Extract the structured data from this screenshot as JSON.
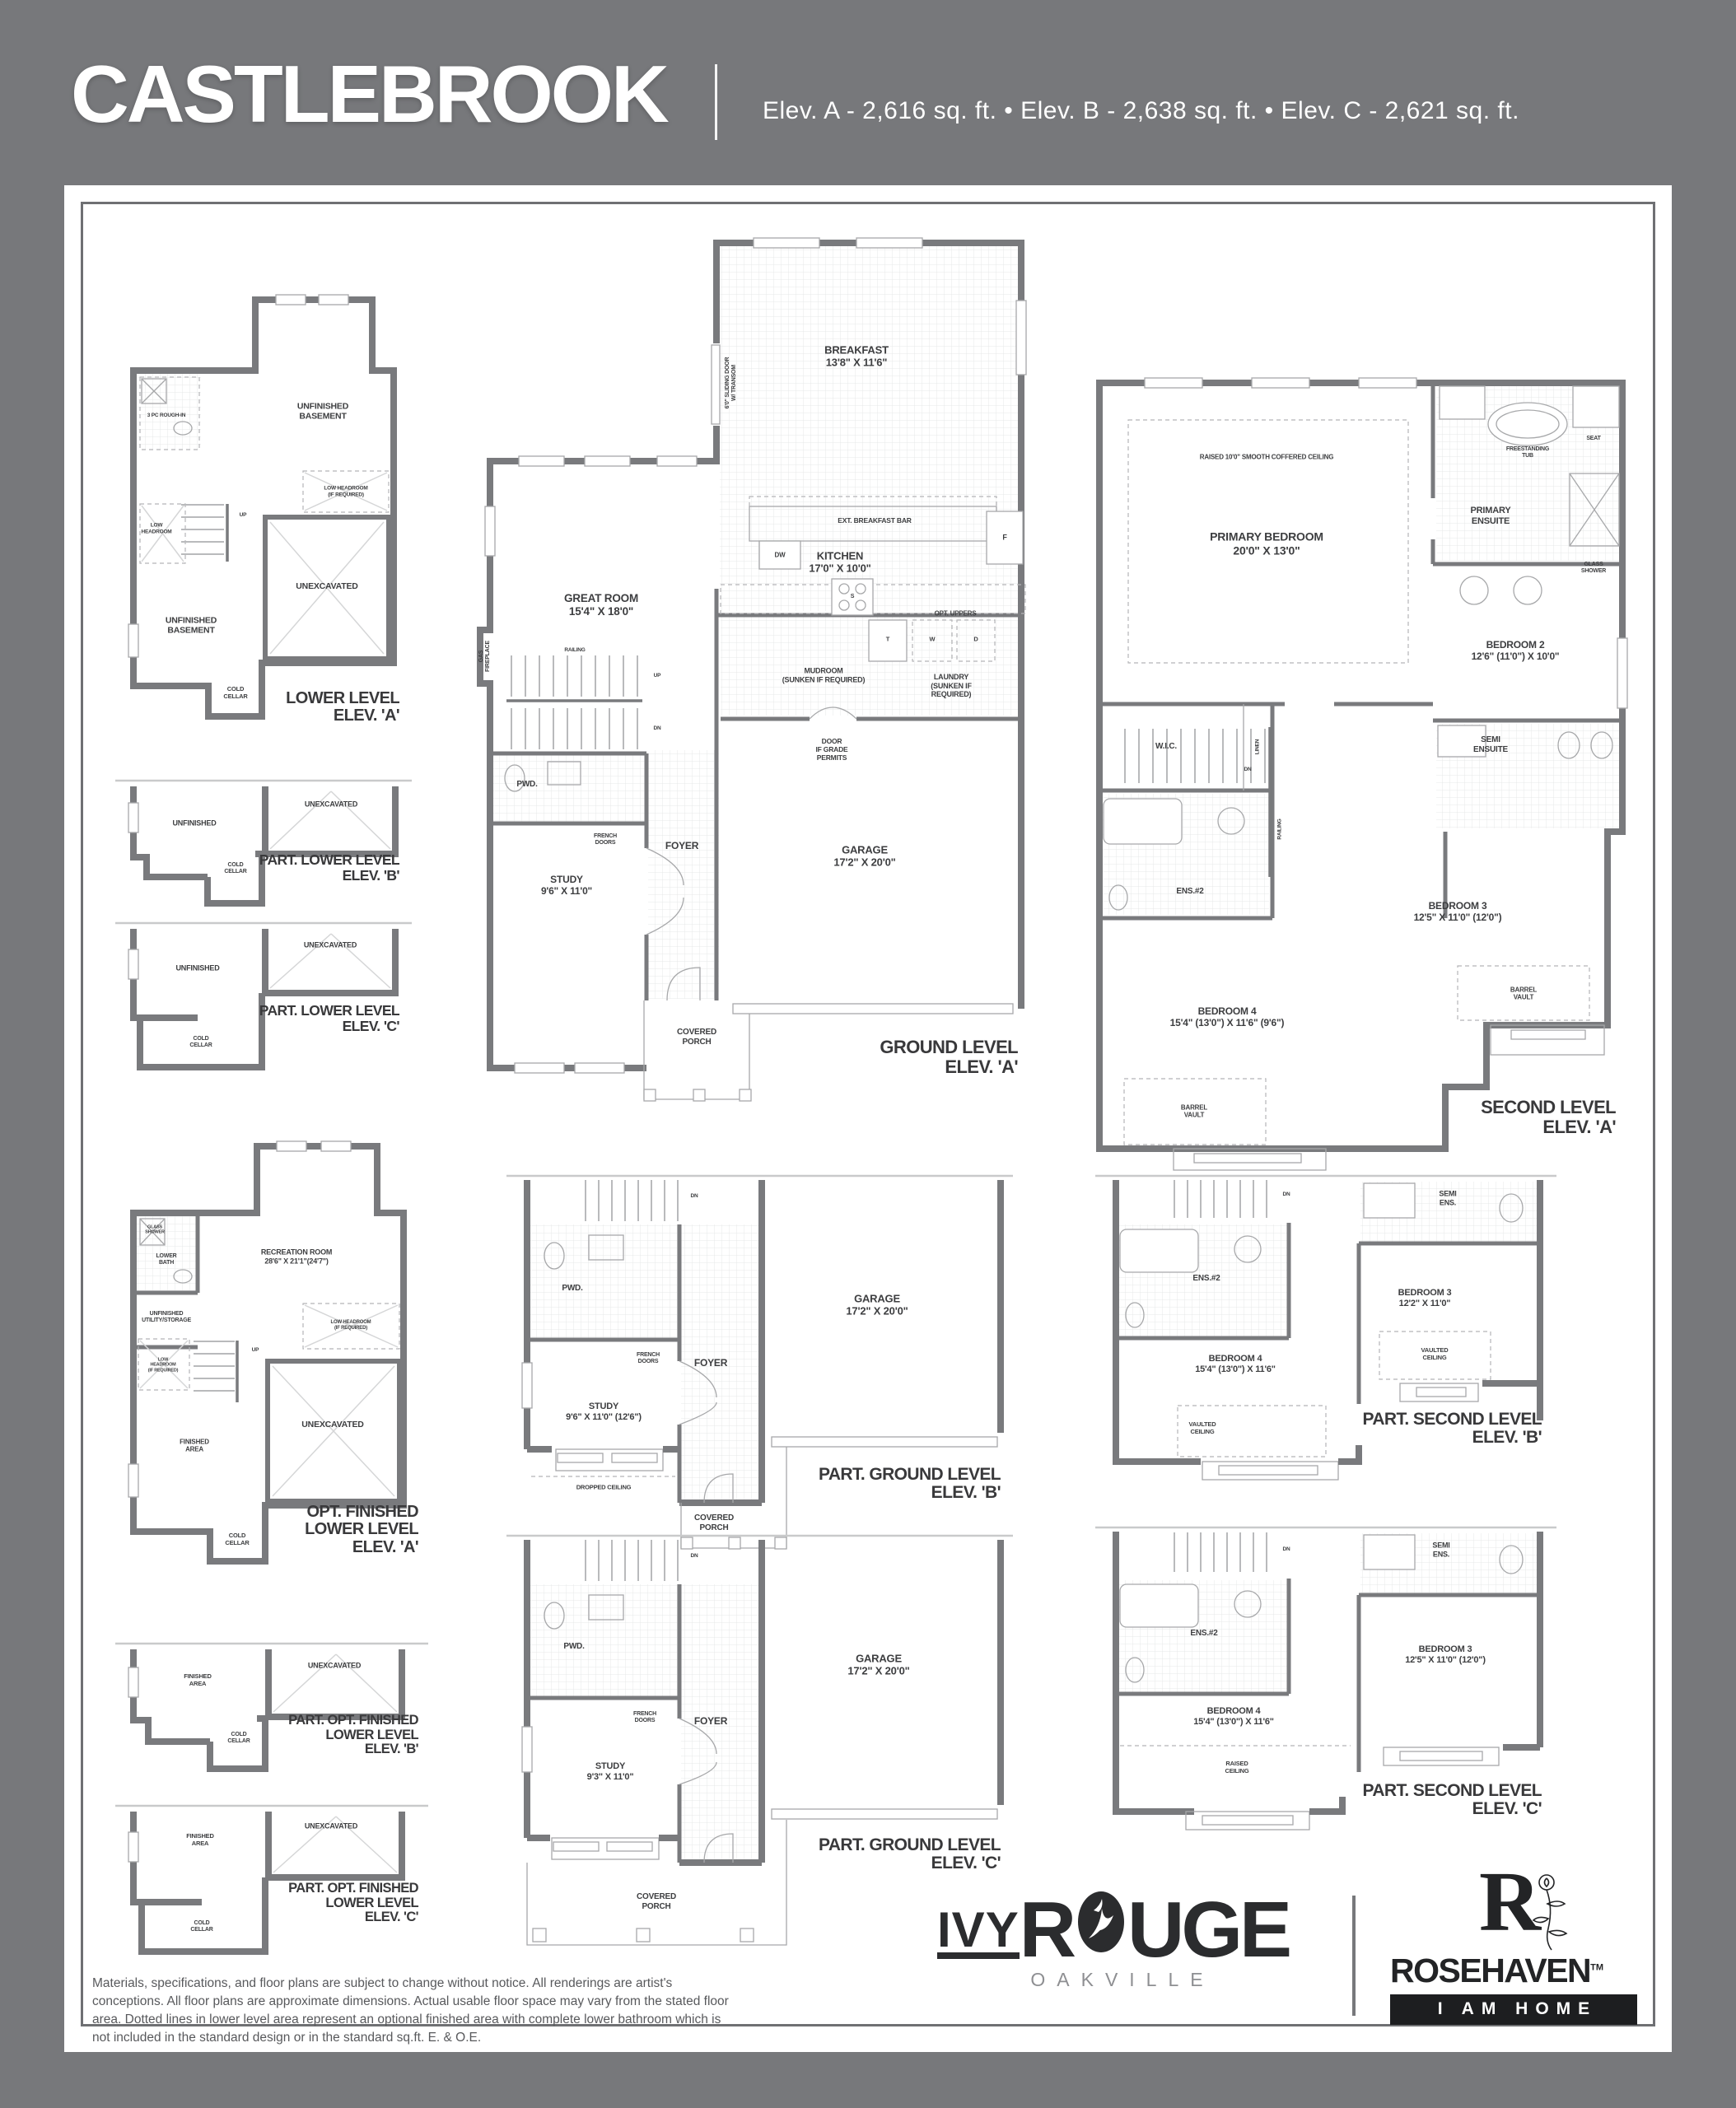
{
  "colors": {
    "page_bg": "#77787b",
    "wall": "#797a7d",
    "panel": "#ffffff",
    "text_dark": "#3d3e40",
    "logo_dark": "#232426"
  },
  "header": {
    "title": "CASTLEBROOK",
    "elevations": "Elev. A - 2,616 sq. ft.  •  Elev. B - 2,638 sq. ft.  •  Elev. C - 2,621 sq. ft."
  },
  "plans": {
    "lower_a": {
      "title": "LOWER LEVEL\nELEV. 'A'",
      "labels": {
        "rough_in": "3 PC ROUGH-IN",
        "unfinished_top": "UNFINISHED\nBASEMENT",
        "low_headroom_req": "LOW HEADROOM\n(IF REQUIRED)",
        "low_headroom": "LOW\nHEADROOM",
        "up": "UP",
        "unexcavated": "UNEXCAVATED",
        "unfinished_bottom": "UNFINISHED\nBASEMENT",
        "cold_cellar": "COLD\nCELLAR"
      }
    },
    "part_lower_b": {
      "title": "PART. LOWER LEVEL\nELEV. 'B'",
      "labels": {
        "unfinished": "UNFINISHED",
        "unexcavated": "UNEXCAVATED",
        "cold_cellar": "COLD\nCELLAR"
      }
    },
    "part_lower_c": {
      "title": "PART. LOWER LEVEL\nELEV. 'C'",
      "labels": {
        "unfinished": "UNFINISHED",
        "unexcavated": "UNEXCAVATED",
        "cold_cellar": "COLD\nCELLAR"
      }
    },
    "ground_a": {
      "title": "GROUND LEVEL\nELEV. 'A'",
      "labels": {
        "breakfast": "BREAKFAST\n13'8\" X 11'6\"",
        "sliding_door": "6'0\" SLIDING DOOR\nW/ TRANSOM",
        "ext_breakfast_bar": "EXT. BREAKFAST BAR",
        "dw": "DW",
        "f": "F",
        "s": "S",
        "t": "T",
        "w": "W",
        "d": "D",
        "great_room": "GREAT ROOM\n15'4\" X 18'0\"",
        "gas_fireplace": "GAS\nFIREPLACE",
        "kitchen": "KITCHEN\n17'0\" X 10'0\"",
        "opt_uppers": "OPT. UPPERS",
        "mudroom": "MUDROOM\n(SUNKEN IF REQUIRED)",
        "laundry": "LAUNDRY\n(SUNKEN IF REQUIRED)",
        "railing": "RAILING",
        "up": "UP",
        "dn": "DN",
        "door_grade": "DOOR\nIF GRADE\nPERMITS",
        "pwd": "PWD.",
        "garage": "GARAGE\n17'2\" X 20'0\"",
        "french_doors": "FRENCH\nDOORS",
        "foyer": "FOYER",
        "study": "STUDY\n9'6\" X 11'0\"",
        "covered_porch": "COVERED\nPORCH"
      }
    },
    "second_a": {
      "title": "SECOND LEVEL\nELEV. 'A'",
      "labels": {
        "raised_ceiling": "RAISED 10'0\" SMOOTH COFFERED CEILING",
        "primary_bedroom": "PRIMARY BEDROOM\n20'0\" X 13'0\"",
        "freestanding_tub": "FREESTANDING\nTUB",
        "seat": "SEAT",
        "primary_ensuite": "PRIMARY\nENSUITE",
        "glass_shower": "GLASS\nSHOWER",
        "wic": "W.I.C.",
        "linen": "LINEN",
        "bedroom2": "BEDROOM 2\n12'6\" (11'0\") X 10'0\"",
        "railing": "RAILING",
        "dn": "DN",
        "semi_ensuite": "SEMI\nENSUITE",
        "ens2": "ENS.#2",
        "bedroom3": "BEDROOM 3\n12'5\" X 11'0\" (12'0\")",
        "barrel_vault_r": "BARREL\nVAULT",
        "bedroom4": "BEDROOM 4\n15'4\" (13'0\") X 11'6\" (9'6\")",
        "barrel_vault_l": "BARREL\nVAULT"
      }
    },
    "opt_lower_a": {
      "title": "OPT. FINISHED\nLOWER LEVEL\nELEV. 'A'",
      "labels": {
        "glass_shower": "GLASS\nSHOWER",
        "lower_bath": "LOWER\nBATH",
        "recreation": "RECREATION ROOM\n28'6\" X 21'1\"(24'7\")",
        "utility": "UNFINISHED\nUTILITY/STORAGE",
        "low_headroom_r": "LOW HEADROOM\n(IF REQUIRED)",
        "low_headroom_l": "LOW\nHEADROOM\n(IF REQUIRED)",
        "up": "UP",
        "unexcavated": "UNEXCAVATED",
        "finished_area": "FINISHED\nAREA",
        "cold_cellar": "COLD\nCELLAR"
      }
    },
    "part_opt_b": {
      "title": "PART. OPT. FINISHED\nLOWER LEVEL\nELEV. 'B'",
      "labels": {
        "finished_area": "FINISHED\nAREA",
        "unexcavated": "UNEXCAVATED",
        "cold_cellar": "COLD\nCELLAR"
      }
    },
    "part_opt_c": {
      "title": "PART. OPT. FINISHED\nLOWER LEVEL\nELEV. 'C'",
      "labels": {
        "finished_area": "FINISHED\nAREA",
        "unexcavated": "UNEXCAVATED",
        "cold_cellar": "COLD\nCELLAR"
      }
    },
    "part_ground_b": {
      "title": "PART. GROUND LEVEL\nELEV. 'B'",
      "labels": {
        "dn": "DN",
        "pwd": "PWD.",
        "garage": "GARAGE\n17'2\" X 20'0\"",
        "french_doors": "FRENCH\nDOORS",
        "foyer": "FOYER",
        "study": "STUDY\n9'6\" X 11'0\" (12'6\")",
        "dropped_ceiling": "DROPPED CEILING",
        "covered_porch": "COVERED\nPORCH"
      }
    },
    "part_second_b": {
      "title": "PART. SECOND LEVEL\nELEV. 'B'",
      "labels": {
        "dn": "DN",
        "semi_ens": "SEMI\nENS.",
        "ens2": "ENS.#2",
        "bedroom3": "BEDROOM 3\n12'2\" X 11'0\"",
        "vaulted_r": "VAULTED\nCEILING",
        "bedroom4": "BEDROOM 4\n15'4\" (13'0\") X 11'6\"",
        "vaulted_l": "VAULTED\nCEILING"
      }
    },
    "part_ground_c": {
      "title": "PART. GROUND LEVEL\nELEV. 'C'",
      "labels": {
        "dn": "DN",
        "pwd": "PWD.",
        "garage": "GARAGE\n17'2\" X 20'0\"",
        "french_doors": "FRENCH\nDOORS",
        "foyer": "FOYER",
        "study": "STUDY\n9'3\" X 11'0\"",
        "covered_porch": "COVERED\nPORCH"
      }
    },
    "part_second_c": {
      "title": "PART. SECOND LEVEL\nELEV. 'C'",
      "labels": {
        "dn": "DN",
        "semi_ens": "SEMI\nENS.",
        "ens2": "ENS.#2",
        "bedroom3": "BEDROOM 3\n12'5\" X 11'0\" (12'0\")",
        "bedroom4": "BEDROOM 4\n15'4\" (13'0\") X 11'6\"",
        "raised_ceiling": "RAISED\nCEILING"
      }
    }
  },
  "footer": {
    "disclaimer": "Materials, specifications, and floor plans are subject to change without notice. All renderings are artist's conceptions. All floor plans are approximate dimensions. Actual usable floor space may vary from the stated floor area. Dotted lines in lower level area represent an optional finished area with complete lower bathroom which is not included in the standard design or in the standard sq.ft. E. & O.E.",
    "ivyrouge": {
      "ivy": "IVY",
      "rouge_r": "R",
      "rouge_rest": "UGE",
      "city": "OAKVILLE"
    },
    "rosehaven": {
      "r": "R",
      "name": "ROSEHAVEN",
      "tm": "TM",
      "tagline": "I AM HOME"
    }
  }
}
